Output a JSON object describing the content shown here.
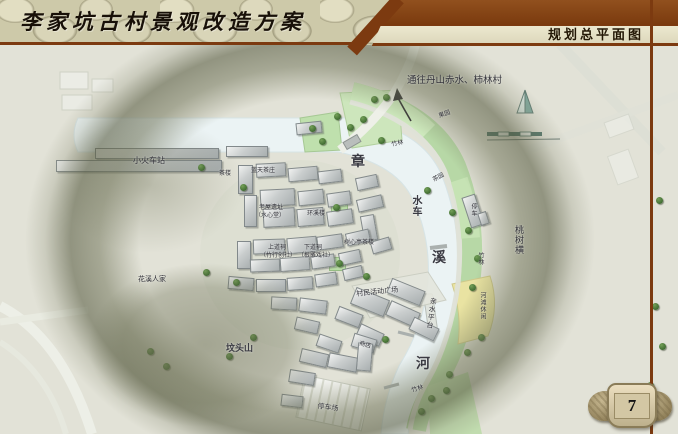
{
  "header": {
    "title": "李家坑古村景观改造方案",
    "section_title": "规划总平面图"
  },
  "page_number": "7",
  "colors": {
    "accent_brown": "#7c3a10",
    "stone_beige": "#cdc9a9",
    "map_background": "#e2e2d7",
    "river": "#ebf3f4",
    "green_band": "#b7d8a6",
    "riverside_yellow": "#e9e3a2",
    "hill_shade_olive": "#666a4e",
    "tree_green": "#3f6b31"
  },
  "map": {
    "river_name": "章溪河",
    "direction_note": "通往丹山赤水、柿林村",
    "labels": [
      {
        "t": "通往丹山赤水、柿林村",
        "x": 407,
        "y": 76,
        "s": 9.5
      },
      {
        "t": "小火车站",
        "x": 133,
        "y": 157,
        "s": 8
      },
      {
        "t": "茶楼",
        "x": 219,
        "y": 171,
        "s": 6
      },
      {
        "t": "蓝天茶庄",
        "x": 251,
        "y": 168,
        "s": 6
      },
      {
        "t": "老屋遗址",
        "x": 259,
        "y": 205,
        "s": 6
      },
      {
        "t": "（水心堂）",
        "x": 255,
        "y": 213,
        "s": 6
      },
      {
        "t": "环溪楼",
        "x": 307,
        "y": 211,
        "s": 6
      },
      {
        "t": "上道祠",
        "x": 268,
        "y": 245,
        "s": 6
      },
      {
        "t": "（竹行创社）",
        "x": 260,
        "y": 253,
        "s": 6
      },
      {
        "t": "下道祠",
        "x": 304,
        "y": 245,
        "s": 6
      },
      {
        "t": "（根雕戏社）",
        "x": 298,
        "y": 253,
        "s": 6
      },
      {
        "t": "树心亭茶楼",
        "x": 344,
        "y": 240,
        "s": 6
      },
      {
        "t": "章",
        "x": 351,
        "y": 156,
        "s": 14,
        "b": true
      },
      {
        "t": "水车",
        "x": 410,
        "y": 195,
        "s": 10,
        "v": true,
        "b": true
      },
      {
        "t": "溪",
        "x": 432,
        "y": 252,
        "s": 14,
        "b": true
      },
      {
        "t": "河",
        "x": 416,
        "y": 358,
        "s": 14,
        "b": true
      },
      {
        "t": "茶园",
        "x": 432,
        "y": 178,
        "s": 6,
        "r": -28
      },
      {
        "t": "果园",
        "x": 438,
        "y": 114,
        "s": 6,
        "r": -20
      },
      {
        "t": "竹林",
        "x": 391,
        "y": 142,
        "s": 6,
        "r": -10
      },
      {
        "t": "竹林",
        "x": 477,
        "y": 252,
        "s": 6,
        "v": true
      },
      {
        "t": "竹林",
        "x": 411,
        "y": 388,
        "s": 6,
        "r": -15
      },
      {
        "t": "桃树横",
        "x": 514,
        "y": 225,
        "s": 9,
        "v": true
      },
      {
        "t": "停车",
        "x": 470,
        "y": 203,
        "s": 6,
        "v": true
      },
      {
        "t": "花溪人家",
        "x": 138,
        "y": 276,
        "s": 7
      },
      {
        "t": "村民活动广场",
        "x": 356,
        "y": 291,
        "s": 7,
        "r": -6
      },
      {
        "t": "亲水平台",
        "x": 430,
        "y": 297,
        "s": 7,
        "v": true,
        "r": 8
      },
      {
        "t": "河滩休闲",
        "x": 479,
        "y": 292,
        "s": 6,
        "v": true
      },
      {
        "t": "坟头山",
        "x": 226,
        "y": 344,
        "s": 9,
        "b": true
      },
      {
        "t": "商店",
        "x": 360,
        "y": 341,
        "s": 6,
        "r": 15
      },
      {
        "t": "停车场",
        "x": 318,
        "y": 403,
        "s": 7,
        "r": 8
      }
    ],
    "trees": [
      [
        201,
        167
      ],
      [
        243,
        187
      ],
      [
        312,
        128
      ],
      [
        322,
        141
      ],
      [
        337,
        116
      ],
      [
        350,
        127
      ],
      [
        363,
        119
      ],
      [
        374,
        99
      ],
      [
        386,
        97
      ],
      [
        381,
        140
      ],
      [
        427,
        190
      ],
      [
        452,
        212
      ],
      [
        468,
        230
      ],
      [
        477,
        258
      ],
      [
        472,
        287
      ],
      [
        481,
        337
      ],
      [
        467,
        352
      ],
      [
        449,
        374
      ],
      [
        431,
        398
      ],
      [
        421,
        411
      ],
      [
        336,
        207
      ],
      [
        339,
        263
      ],
      [
        366,
        276
      ],
      [
        385,
        339
      ],
      [
        236,
        282
      ],
      [
        206,
        272
      ],
      [
        150,
        351
      ],
      [
        166,
        366
      ],
      [
        229,
        356
      ],
      [
        253,
        337
      ],
      [
        446,
        390
      ],
      [
        659,
        200
      ],
      [
        655,
        306
      ],
      [
        662,
        346
      ],
      [
        650,
        385
      ],
      [
        657,
        416
      ]
    ],
    "buildings": [
      [
        95,
        148,
        122,
        9,
        0
      ],
      [
        56,
        160,
        164,
        10,
        0
      ],
      [
        226,
        146,
        40,
        9,
        0
      ],
      [
        296,
        122,
        24,
        10,
        -6
      ],
      [
        238,
        165,
        13,
        27,
        0
      ],
      [
        256,
        163,
        28,
        12,
        -3
      ],
      [
        288,
        167,
        28,
        12,
        -5
      ],
      [
        318,
        170,
        22,
        11,
        -7
      ],
      [
        356,
        176,
        20,
        11,
        -12
      ],
      [
        244,
        195,
        11,
        30,
        0
      ],
      [
        260,
        189,
        33,
        15,
        -3
      ],
      [
        298,
        190,
        24,
        13,
        -6
      ],
      [
        327,
        192,
        22,
        12,
        -8
      ],
      [
        357,
        197,
        24,
        11,
        -13
      ],
      [
        263,
        208,
        30,
        17,
        -3
      ],
      [
        297,
        208,
        25,
        16,
        -5
      ],
      [
        327,
        210,
        24,
        13,
        -8
      ],
      [
        362,
        215,
        12,
        24,
        -10
      ],
      [
        237,
        241,
        12,
        26,
        0
      ],
      [
        253,
        239,
        30,
        13,
        -2
      ],
      [
        287,
        237,
        28,
        14,
        -5
      ],
      [
        317,
        235,
        24,
        12,
        -8
      ],
      [
        346,
        231,
        22,
        11,
        -13
      ],
      [
        250,
        259,
        28,
        11,
        -2
      ],
      [
        280,
        257,
        28,
        12,
        -4
      ],
      [
        311,
        255,
        22,
        11,
        -8
      ],
      [
        339,
        251,
        20,
        11,
        -12
      ],
      [
        228,
        277,
        24,
        11,
        5
      ],
      [
        256,
        279,
        28,
        11,
        0
      ],
      [
        287,
        277,
        24,
        11,
        -4
      ],
      [
        315,
        273,
        20,
        11,
        -8
      ],
      [
        343,
        267,
        18,
        10,
        -13
      ],
      [
        371,
        239,
        18,
        11,
        -16
      ],
      [
        352,
        293,
        34,
        16,
        22
      ],
      [
        387,
        306,
        30,
        14,
        24
      ],
      [
        410,
        322,
        26,
        12,
        26
      ],
      [
        336,
        310,
        24,
        12,
        21
      ],
      [
        357,
        328,
        24,
        12,
        25
      ],
      [
        299,
        299,
        26,
        12,
        7
      ],
      [
        271,
        297,
        24,
        11,
        3
      ],
      [
        295,
        319,
        22,
        11,
        13
      ],
      [
        317,
        337,
        22,
        11,
        19
      ],
      [
        352,
        336,
        22,
        12,
        17
      ],
      [
        300,
        351,
        26,
        12,
        13
      ],
      [
        328,
        355,
        28,
        13,
        11
      ],
      [
        357,
        343,
        13,
        26,
        5
      ],
      [
        289,
        371,
        24,
        11,
        9
      ],
      [
        281,
        395,
        20,
        10,
        7
      ],
      [
        466,
        195,
        12,
        30,
        -18
      ],
      [
        479,
        212,
        7,
        11,
        -18
      ],
      [
        388,
        284,
        34,
        14,
        22
      ]
    ]
  }
}
